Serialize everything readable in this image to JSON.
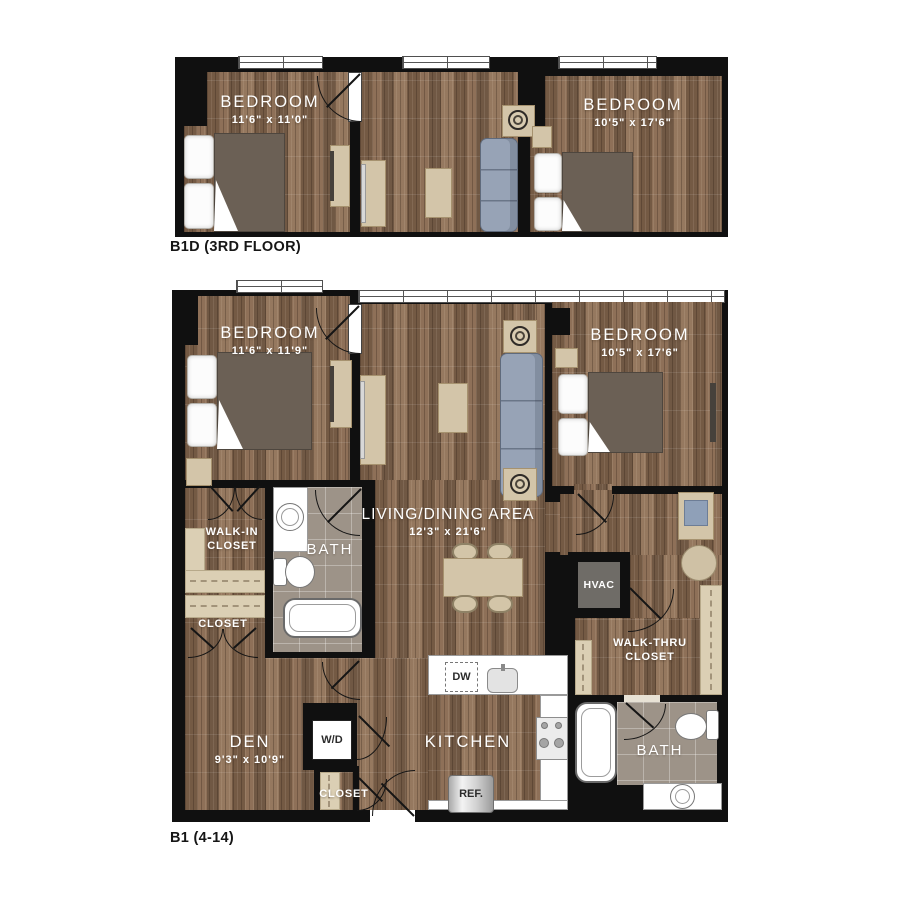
{
  "colors": {
    "wood": "#8b6f57",
    "wall": "#101010",
    "tile": "#9d9388",
    "shelf": "#dbcfb4",
    "sofa": "#97a3b6",
    "mattress": "#6b6055",
    "counter": "#ffffff",
    "hvac": "#6f6c67"
  },
  "b1d": {
    "label": "B1D (3RD FLOOR)",
    "bedroom1": {
      "name": "BEDROOM",
      "dims": "11'6\" x 11'0\""
    },
    "bedroom2": {
      "name": "BEDROOM",
      "dims": "10'5\" x 17'6\""
    }
  },
  "b1": {
    "label": "B1 (4-14)",
    "bedroom1": {
      "name": "BEDROOM",
      "dims": "11'6\" x 11'9\""
    },
    "bedroom2": {
      "name": "BEDROOM",
      "dims": "10'5\" x 17'6\""
    },
    "living": {
      "name": "LIVING/DINING AREA",
      "dims": "12'3\" x 21'6\""
    },
    "walk_in_closet": {
      "name": "WALK-IN CLOSET"
    },
    "bath1": {
      "name": "BATH"
    },
    "closet1": {
      "name": "CLOSET"
    },
    "den": {
      "name": "DEN",
      "dims": "9'3\" x 10'9\""
    },
    "wd": {
      "name": "W/D"
    },
    "closet2": {
      "name": "CLOSET"
    },
    "kitchen": {
      "name": "KITCHEN"
    },
    "hvac": {
      "name": "HVAC"
    },
    "walk_thru_closet": {
      "name": "WALK-THRU CLOSET"
    },
    "bath2": {
      "name": "BATH"
    },
    "appliances": {
      "dw": "DW",
      "ref": "REF."
    }
  }
}
